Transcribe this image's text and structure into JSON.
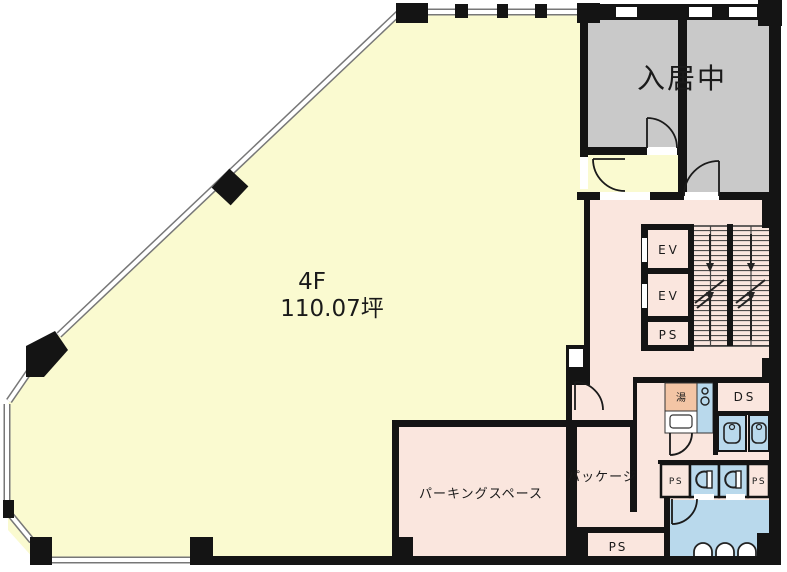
{
  "floor_plan": {
    "unit": {
      "floor_label": "4F",
      "area_label": "110.07坪"
    },
    "occupied_unit": {
      "label": "入居中"
    },
    "core": {
      "elevator_upper": "EV",
      "elevator_lower": "EV",
      "pipe_space": "PS"
    },
    "facilities": {
      "hot_water": "湯",
      "duct_space": "DS",
      "pipe_space_left": "PS",
      "pipe_space_right": "PS",
      "pipe_space_room": "PS"
    },
    "rooms": {
      "parking": "パーキングスペース",
      "package": "パッケージ"
    },
    "colors": {
      "wall": "#141414",
      "main_room": "#fafad0",
      "corridor": "#fae6de",
      "occupied": "#c9c9c9",
      "wet_area": "#b9d9ec",
      "hot_water_box": "#f3c5a5",
      "window_line": "#777777"
    }
  }
}
